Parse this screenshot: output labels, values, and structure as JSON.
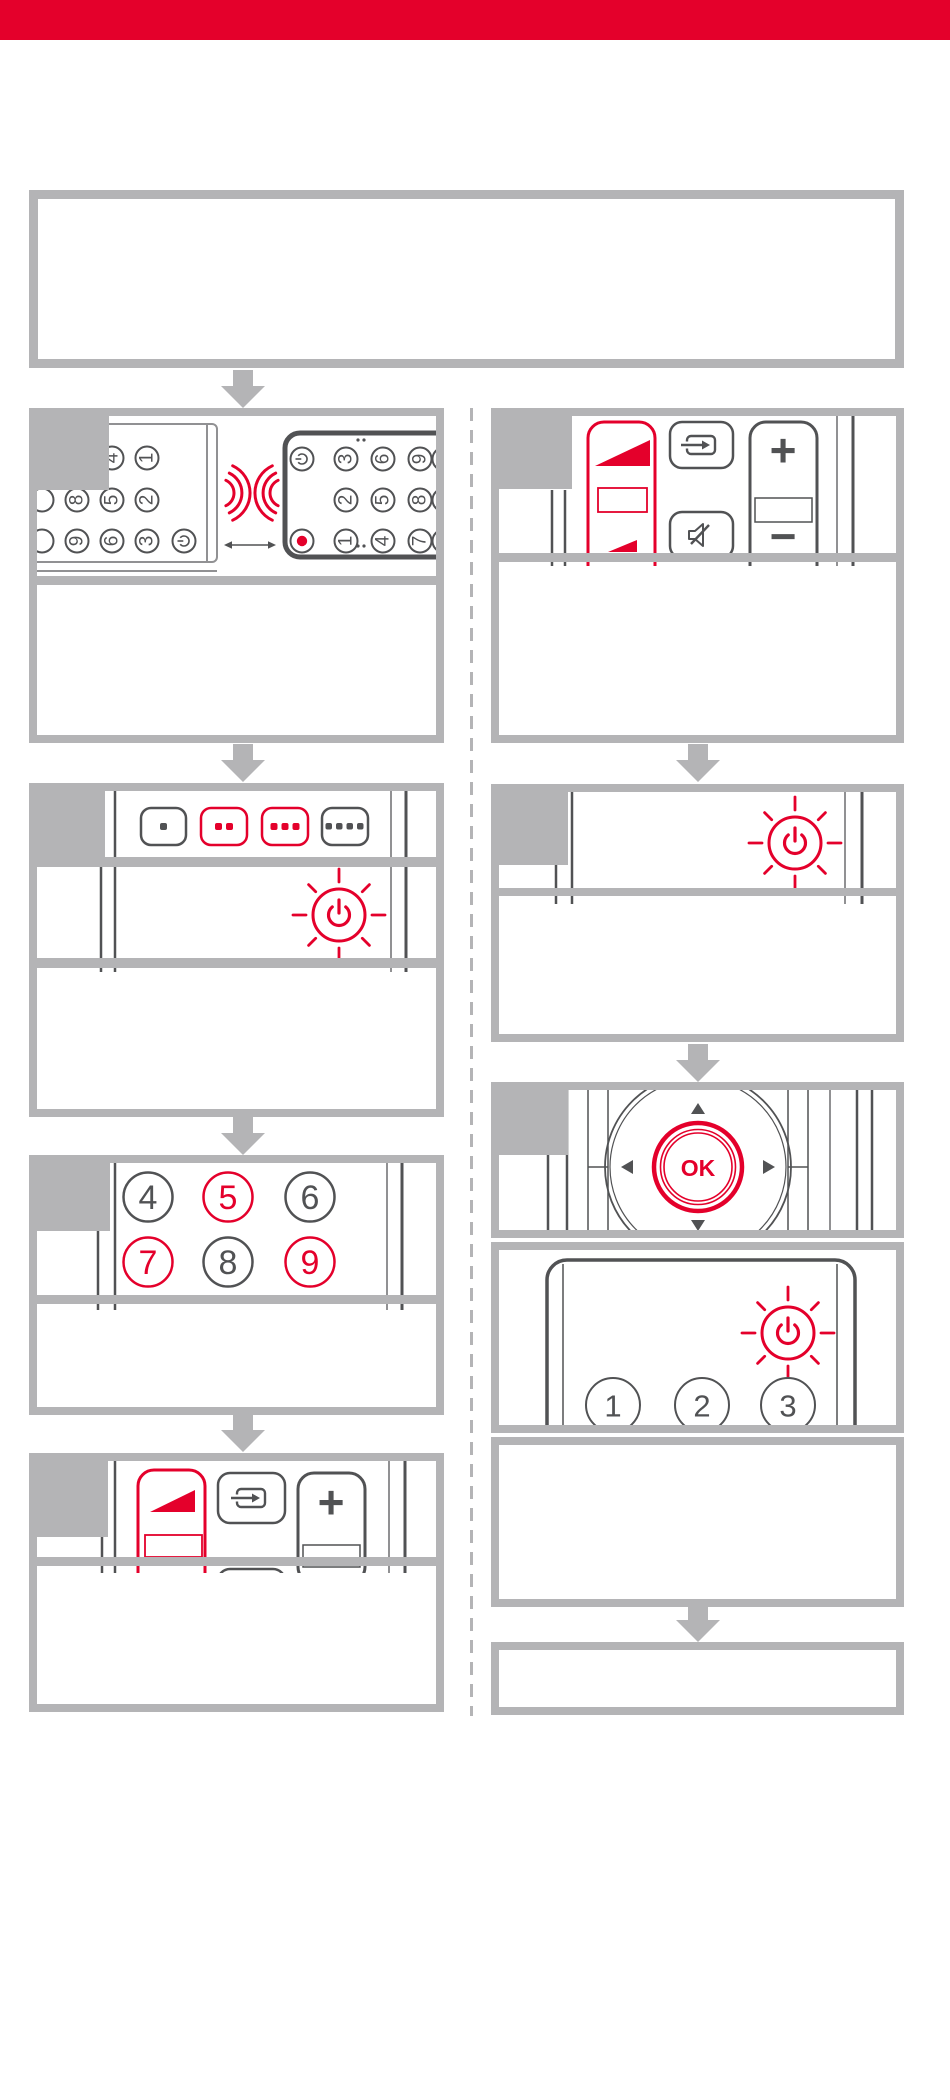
{
  "colors": {
    "accent_red": "#e4002b",
    "border_gray": "#b4b4b6",
    "line_dark": "#515254"
  },
  "pairing_step": {
    "source_remote_digits": [
      "1",
      "2",
      "3",
      "4",
      "5",
      "6",
      "7",
      "8",
      "9"
    ],
    "target_remote_digits_col_top": [
      "3",
      "6",
      "9"
    ],
    "target_remote_digits_col_mid": [
      "2",
      "5",
      "8"
    ],
    "target_remote_digits_col_bottom": [
      "1",
      "4",
      "7"
    ]
  },
  "mode_step": {
    "dot_counts": [
      1,
      2,
      3,
      4
    ],
    "highlighted": [
      false,
      true,
      true,
      false
    ]
  },
  "code_step": {
    "digits_row1": [
      "4",
      "5",
      "6"
    ],
    "digits_row2": [
      "7",
      "8",
      "9"
    ],
    "highlighted_digits": [
      "5",
      "7",
      "9"
    ]
  },
  "volume_controls": {
    "plus": "+",
    "minus": "−"
  },
  "navigation_step": {
    "ok": "OK"
  },
  "device_remote_step": {
    "digits": [
      "1",
      "2",
      "3"
    ]
  }
}
